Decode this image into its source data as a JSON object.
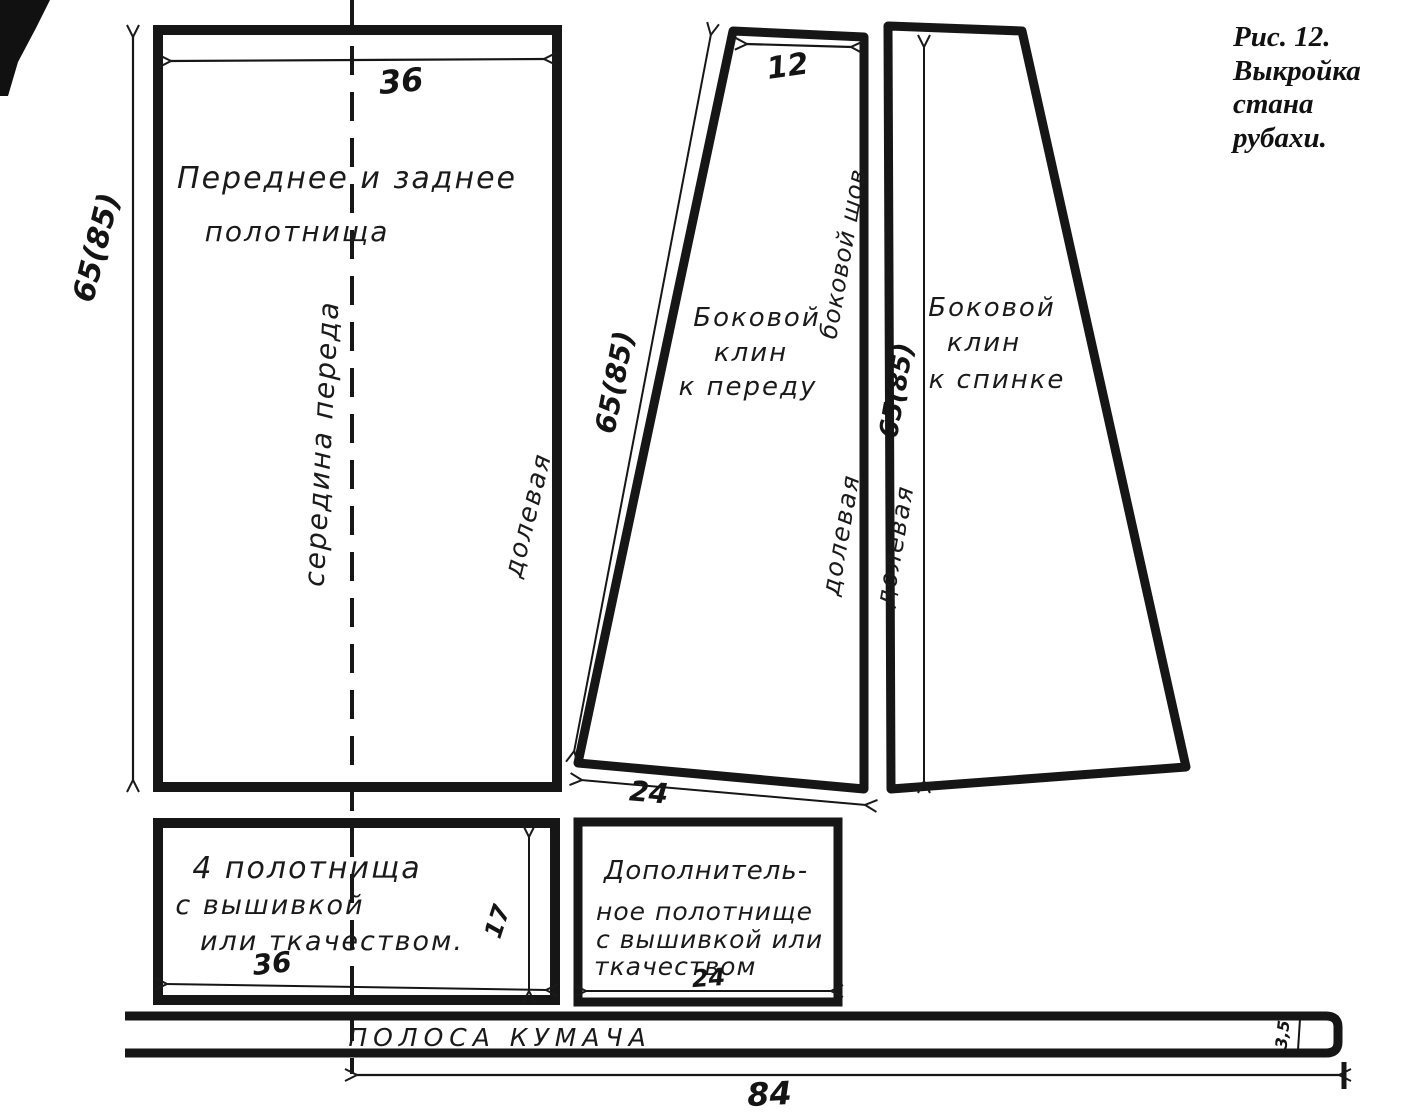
{
  "figure_caption": {
    "lines": [
      "Рис. 12.",
      "Выкройка",
      "стана",
      "рубахи."
    ]
  },
  "colors": {
    "ink": "#1a1a1a",
    "paper": "#ffffff"
  },
  "pieces": {
    "front_back_panel": {
      "name_line1": "Переднее  и заднее",
      "name_line2": "полотнища",
      "width_dim": "36",
      "length_dim": "65(85)",
      "center_front_label": "середина переда",
      "grain_label": "долевая"
    },
    "front_side_gusset": {
      "name_line1": "Боковой",
      "name_line2": "клин",
      "name_line3": "к переду",
      "top_dim": "12",
      "slant_dim": "65(85)",
      "bottom_dim": "24",
      "side_seam_label": "боковой шов",
      "grain_label": "долевая"
    },
    "back_side_gusset": {
      "name_line1": "Боковой",
      "name_line2": "клин",
      "name_line3": "к спинке",
      "length_dim": "65(85)",
      "grain_label": "долевая"
    },
    "embroidered_panels": {
      "name_line1": "4 полотнища",
      "name_line2": "с вышивкой",
      "name_line3": "или ткачеством.",
      "width_dim": "36",
      "height_dim": "17"
    },
    "additional_panel": {
      "name_line1": "Дополнитель-",
      "name_line2": "ное полотнище",
      "name_line3": "с вышивкой или",
      "name_line4": "ткачеством",
      "width_dim": "24"
    },
    "kumach_strip": {
      "name": "ПОЛОСА КУМАЧА",
      "length_dim": "84",
      "width_dim": "3,5"
    }
  }
}
